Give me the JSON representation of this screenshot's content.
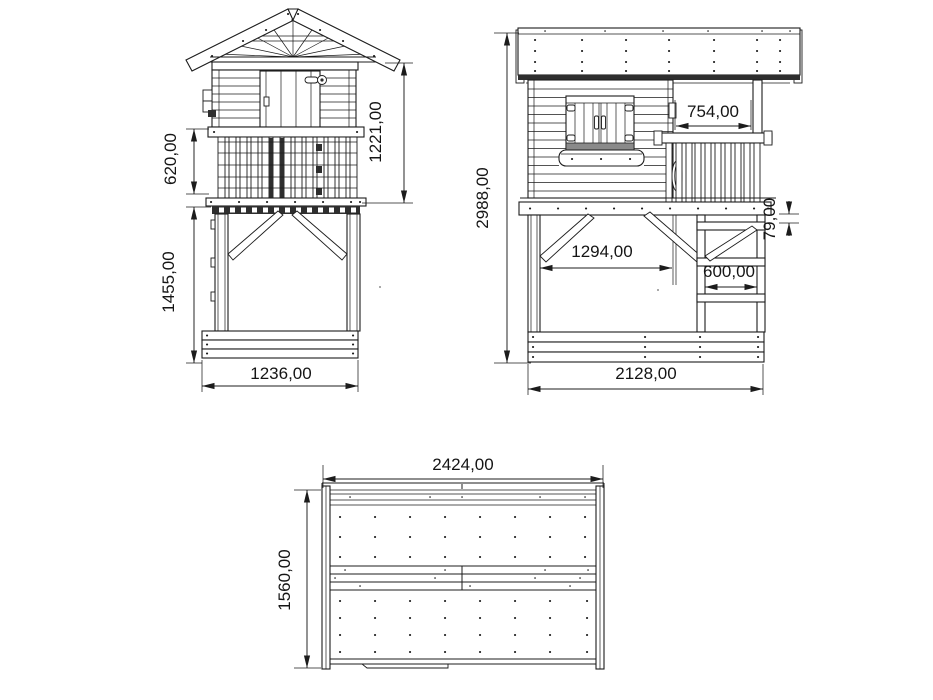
{
  "drawing": {
    "views": {
      "front": {
        "name": "front-elevation",
        "dims": {
          "balustrade_height": "620,00",
          "cabin_height": "1221,00",
          "leg_height": "1455,00",
          "base_width": "1236,00"
        }
      },
      "side": {
        "name": "side-elevation",
        "dims": {
          "total_height": "2988,00",
          "balcony_width": "754,00",
          "step_offset": "79,00",
          "frame_inner_width": "1294,00",
          "ladder_width": "600,00",
          "base_width": "2128,00"
        }
      },
      "plan": {
        "name": "roof-plan",
        "dims": {
          "roof_width": "2424,00",
          "roof_depth": "1560,00"
        }
      }
    },
    "colors": {
      "line": "#1c1c1c",
      "background": "#ffffff"
    }
  }
}
